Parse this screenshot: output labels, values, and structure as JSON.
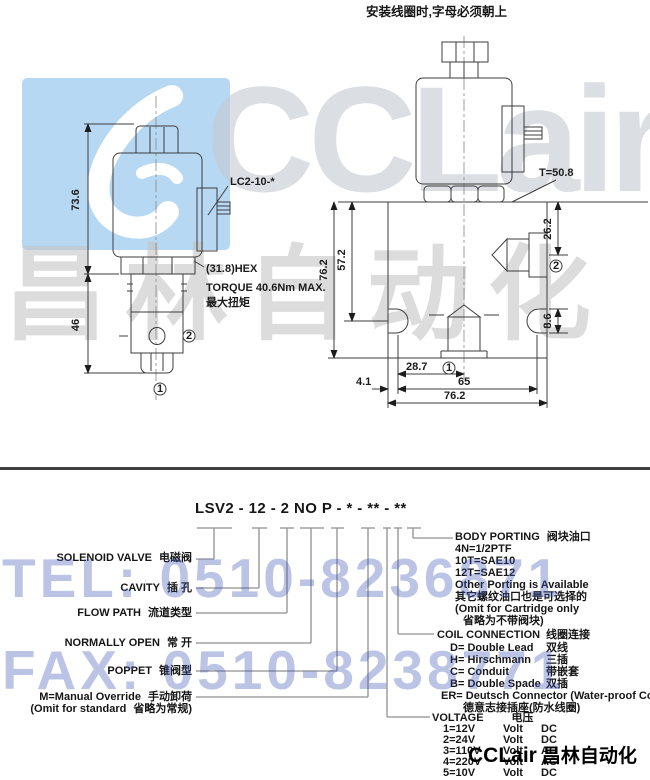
{
  "page": {
    "top_note": "安装线圈时,字母必须朝上"
  },
  "watermarks": {
    "brand": "CCLair",
    "brand_cn": "昌林自动化",
    "tel": "TEL: 0510-8236871",
    "fax": "FAX: 0510-8238771",
    "logo_box_color": "#b7d8f2",
    "tel_fax_color": "#3d55b8"
  },
  "footer": {
    "brand": "CCLair",
    "cn": "昌林自动化"
  },
  "front_view": {
    "labels": {
      "coil": "LC2-10-*",
      "hex": "(31.8)HEX",
      "torque_en": "TORQUE 40.6Nm MAX.",
      "torque_cn": "最大扭矩"
    },
    "dims": {
      "coil_stack_height": "73.6",
      "cartridge_length": "46"
    },
    "markers": {
      "port1": "1",
      "port2": "2"
    }
  },
  "side_view": {
    "labels": {
      "tightening": "T=50.8"
    },
    "dims": {
      "body_height": "76.2",
      "surface_to_slot": "57.2",
      "port2_drop": "26.2",
      "slot_width": "8.6",
      "center_offset": "28.7",
      "slot_spacing": "65",
      "edge_to_slot": "4.1",
      "body_width": "76.2"
    },
    "markers": {
      "port1": "1",
      "port2": "2"
    }
  },
  "ordering": {
    "model_code": "LSV2 - 12 - 2 NO P - * - ** - **",
    "left_labels": [
      {
        "en": "SOLENOID VALVE",
        "cn": "电磁阀"
      },
      {
        "en": "CAVITY",
        "cn": "插 孔"
      },
      {
        "en": "FLOW PATH",
        "cn": "流道类型"
      },
      {
        "en": "NORMALLY OPEN",
        "cn": "常 开"
      },
      {
        "en": "POPPET",
        "cn": "锥阀型"
      },
      {
        "en": "M=Manual Override",
        "cn": "手动卸荷"
      },
      {
        "en": "(Omit for standard",
        "cn": "省略为常规)"
      }
    ],
    "body_porting": {
      "title_en": "BODY PORTING",
      "title_cn": "阀块油口",
      "lines": [
        "4N=1/2PTF",
        "10T=SAE10",
        "12T=SAE12",
        "Other Porting is Available",
        "其它螺纹油口也是可选择的",
        "(Omit for Cartridge only",
        "省略为不带阀块)"
      ]
    },
    "coil_connection": {
      "title_en": "COIL CONNECTION",
      "title_cn": "线圈连接",
      "options": [
        {
          "code": "D=",
          "en": "Double Lead",
          "cn": "双线"
        },
        {
          "code": "H=",
          "en": "Hirschmann",
          "cn": "三插"
        },
        {
          "code": "C=",
          "en": "Conduit",
          "cn": "带嵌套"
        },
        {
          "code": "B=",
          "en": "Double Spade",
          "cn": "双插"
        },
        {
          "code": "ER=",
          "en": "Deutsch Connector (Water-proof Coil)",
          "cn": ""
        }
      ],
      "er_cn": "德意志接插座(防水线圈)"
    },
    "voltage": {
      "title_en": "VOLTAGE",
      "title_cn": "电压",
      "options": [
        {
          "code": "1=12V",
          "unit": "Volt",
          "type": "DC"
        },
        {
          "code": "2=24V",
          "unit": "Volt",
          "type": "DC"
        },
        {
          "code": "3=110V",
          "unit": "Volt",
          "type": "AC"
        },
        {
          "code": "4=220V",
          "unit": "Volt",
          "type": "AC"
        },
        {
          "code": "5=10V",
          "unit": "Volt",
          "type": "DC"
        }
      ]
    }
  }
}
